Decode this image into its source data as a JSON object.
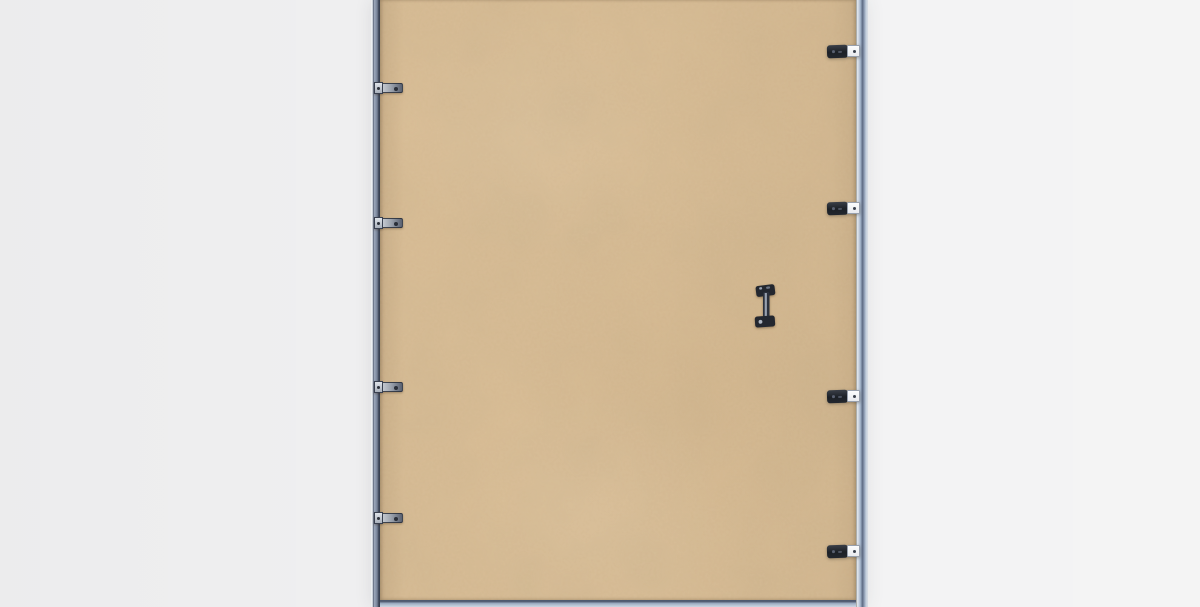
{
  "scene": {
    "name": "picture-frame-back-photo",
    "description": "Rear view of a picture frame: kraft backing board held in a silver-blue metal frame by retainer clips, with a vertical metal hanger bracket, on a plain light gray background",
    "background_color": "#efeff0"
  },
  "colors": {
    "board": "#d7bb93",
    "board_shade": "#c9ac83",
    "edge_light": "#ccd6e3",
    "edge_mid": "#8c99ae",
    "edge_dark": "#49536a",
    "clip_black": "#20242b",
    "clip_plate": "#f3f4f6",
    "clip_metal": "#9aa1ac",
    "screw_dark": "#2a2f39"
  },
  "frame_geometry": {
    "left": 371,
    "top": 0,
    "width": 497,
    "height": 607
  },
  "hardware": {
    "left_clips": {
      "count": 4,
      "centers_y": [
        88,
        223,
        387,
        518
      ]
    },
    "right_clips": {
      "count": 4,
      "centers_y": [
        51,
        208,
        396,
        551
      ]
    },
    "hanger_bracket": {
      "x": 382,
      "y": 283,
      "width": 26,
      "height": 46
    }
  }
}
